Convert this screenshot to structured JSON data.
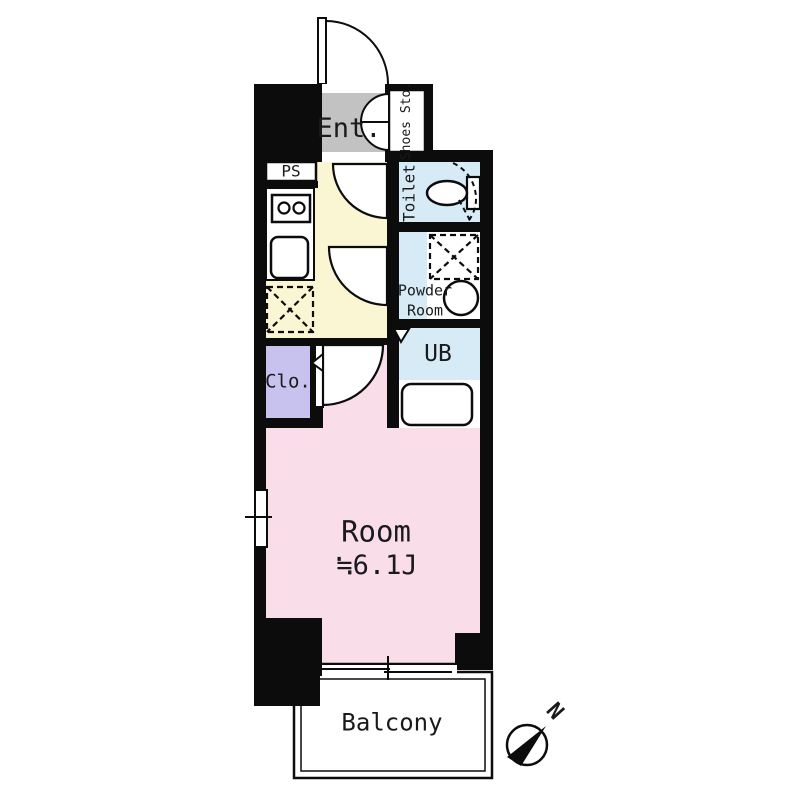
{
  "title": "Apartment floor plan",
  "rooms": {
    "entrance": {
      "label": "Ent."
    },
    "shoes_storage": {
      "label": "Shoes Sto."
    },
    "pipe_space": {
      "label": "PS"
    },
    "toilet": {
      "label": "Toilet"
    },
    "powder_room": {
      "label": "Powder\nRoom"
    },
    "unit_bath": {
      "label": "UB"
    },
    "closet": {
      "label": "Clo."
    },
    "main_room": {
      "label": "Room",
      "area": "≒6.1J"
    },
    "balcony": {
      "label": "Balcony"
    }
  },
  "compass": {
    "label": "N",
    "direction": "north-east"
  },
  "palette": {
    "wall": "#0c0c0c",
    "entrance": "#c2c2c2",
    "kitchen_hall": "#faf5d2",
    "wet_rooms": "#d6ebf6",
    "main_room": "#f9dee9",
    "closet": "#c7c3ee",
    "fixtures": "#ffffff"
  }
}
